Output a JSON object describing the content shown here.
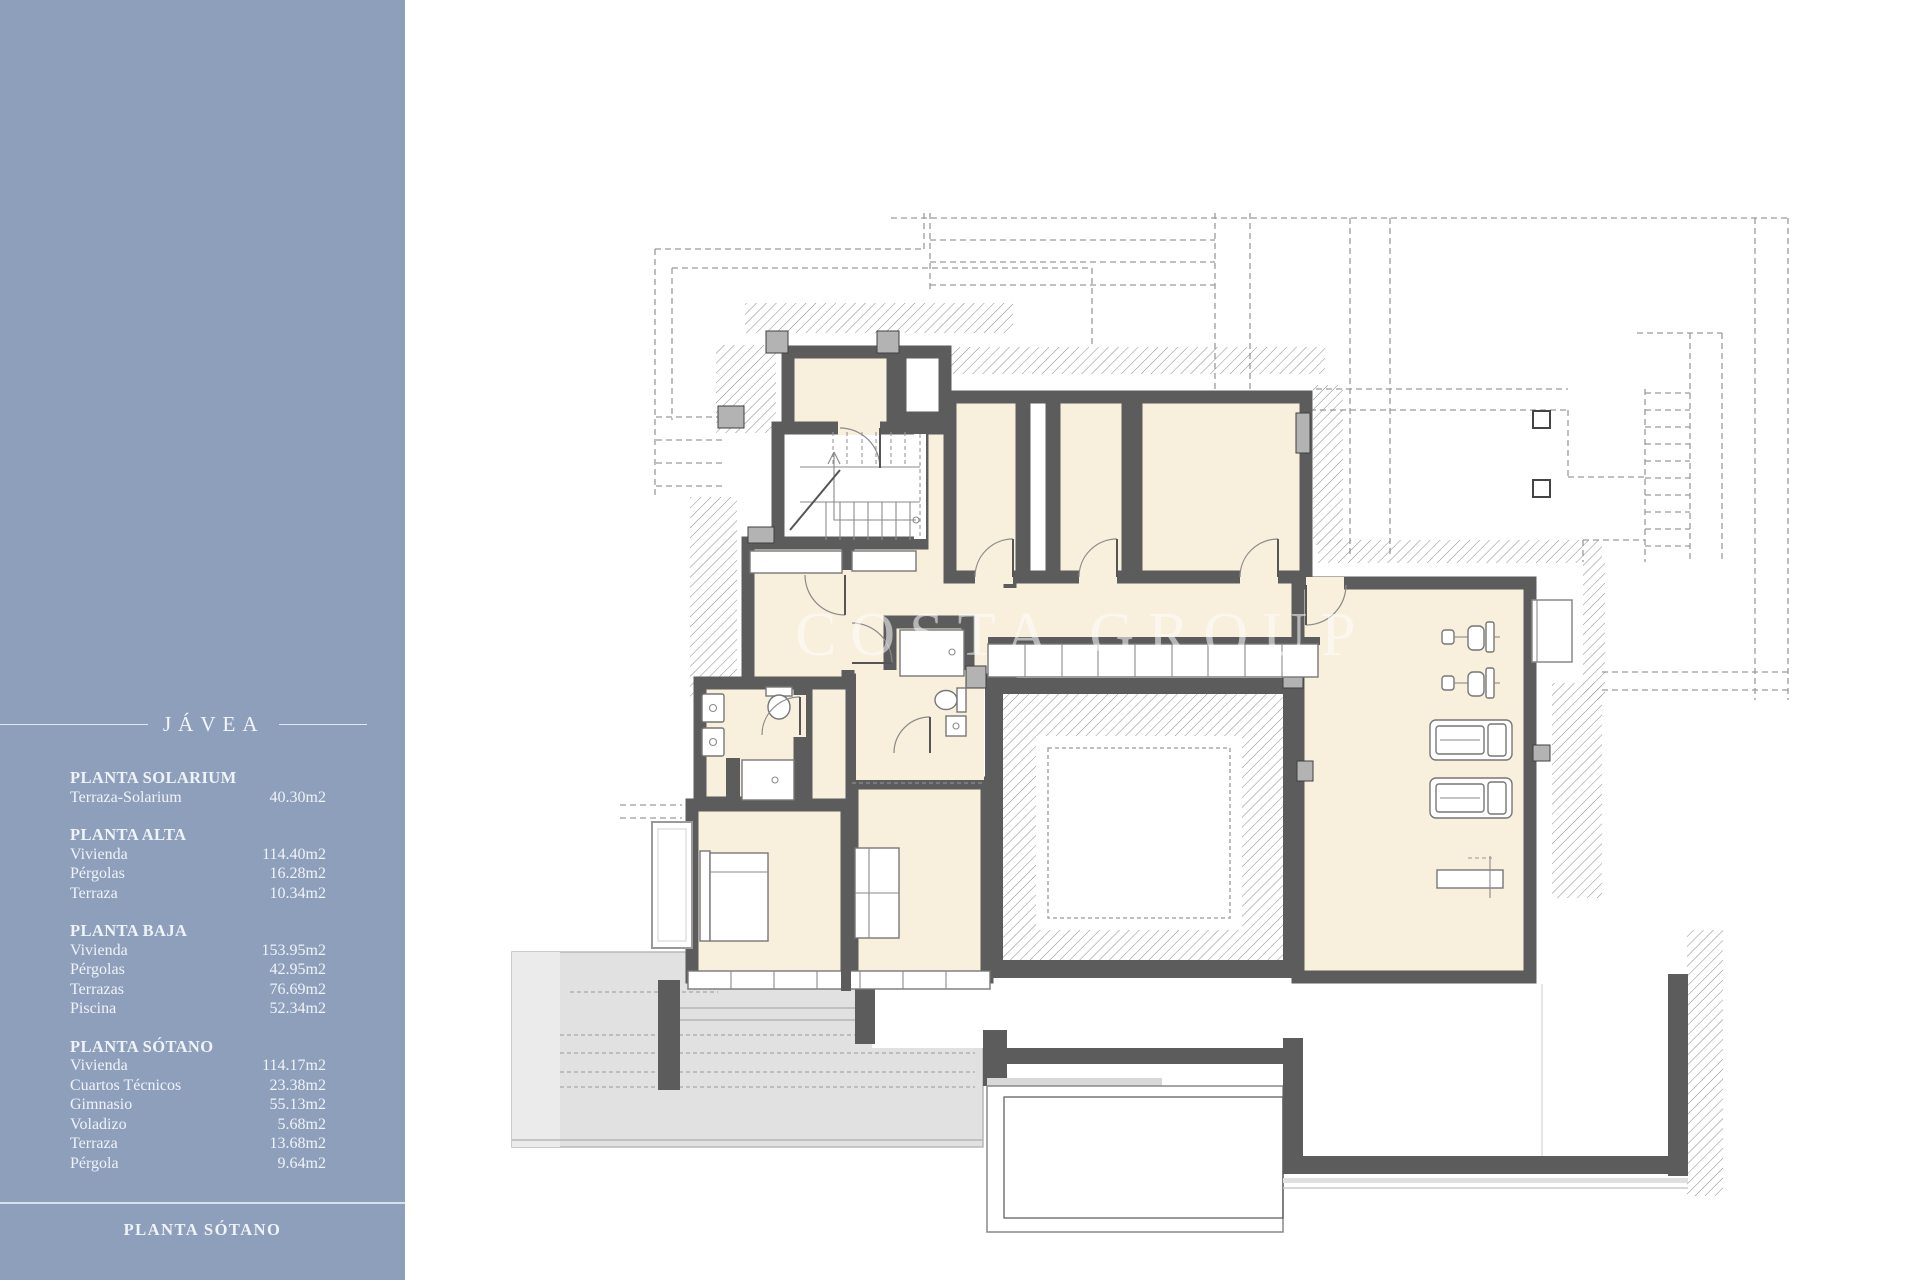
{
  "sidebar": {
    "title": "JÁVEA",
    "sections": [
      {
        "header": "PLANTA SOLARIUM",
        "rows": [
          {
            "label": "Terraza-Solarium",
            "value": "40.30m2"
          }
        ]
      },
      {
        "header": "PLANTA ALTA",
        "rows": [
          {
            "label": "Vivienda",
            "value": "114.40m2"
          },
          {
            "label": "Pérgolas",
            "value": "16.28m2"
          },
          {
            "label": "Terraza",
            "value": "10.34m2"
          }
        ]
      },
      {
        "header": "PLANTA BAJA",
        "rows": [
          {
            "label": "Vivienda",
            "value": "153.95m2"
          },
          {
            "label": "Pérgolas",
            "value": "42.95m2"
          },
          {
            "label": "Terrazas",
            "value": "76.69m2"
          },
          {
            "label": "Piscina",
            "value": "52.34m2"
          }
        ]
      },
      {
        "header": "PLANTA SÓTANO",
        "rows": [
          {
            "label": "Vivienda",
            "value": "114.17m2"
          },
          {
            "label": "Cuartos Técnicos",
            "value": "23.38m2"
          },
          {
            "label": "Gimnasio",
            "value": "55.13m2"
          },
          {
            "label": "Voladizo",
            "value": "5.68m2"
          },
          {
            "label": "Terraza",
            "value": "13.68m2"
          },
          {
            "label": "Pérgola",
            "value": "9.64m2"
          }
        ]
      }
    ],
    "footer": "PLANTA SÓTANO"
  },
  "plan": {
    "watermark": "COSTA GROUP"
  },
  "colors": {
    "sidebar_bg": "#8e9fbb",
    "wall": "#5c5c5c",
    "room_fill": "#f8efdc",
    "terrace_gray": "#e1e1e1"
  }
}
